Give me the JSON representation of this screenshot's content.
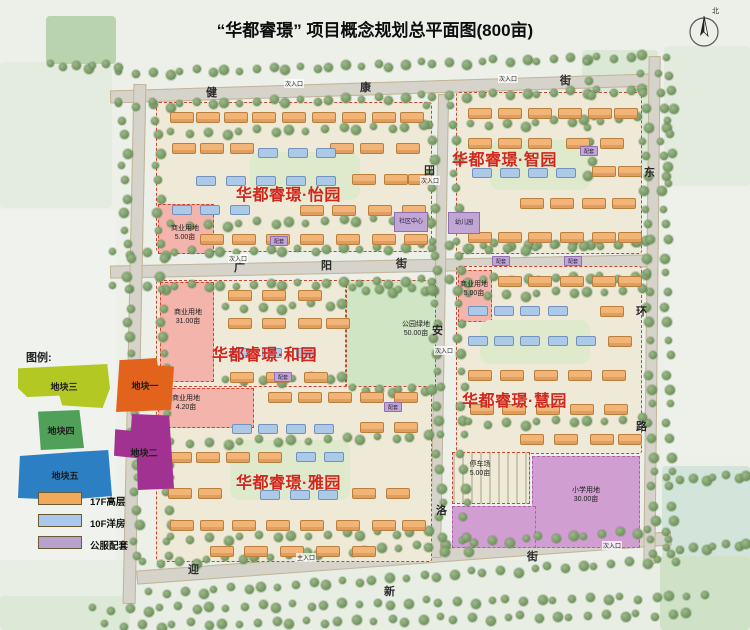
{
  "title": "“华都睿璟” 项目概念规划总平面图(800亩)",
  "compass": {
    "label": "北"
  },
  "legend": {
    "heading": "图例:",
    "plots": [
      {
        "label": "地块一",
        "color": "#e2641c"
      },
      {
        "label": "地块二",
        "color": "#a23292"
      },
      {
        "label": "地块三",
        "color": "#b3c822"
      },
      {
        "label": "地块四",
        "color": "#51a05a"
      },
      {
        "label": "地块五",
        "color": "#2d7fc3"
      }
    ],
    "types": [
      {
        "label": "17F高层",
        "color": "#f1a95e"
      },
      {
        "label": "10F洋房",
        "color": "#a9c8ec"
      },
      {
        "label": "公服配套",
        "color": "#b7a2cf"
      }
    ]
  },
  "gardens": [
    {
      "name": "华都睿璟·怡园"
    },
    {
      "name": "华都睿璟·智园"
    },
    {
      "name": "华都睿璟·和园"
    },
    {
      "name": "华都睿璟·慧园"
    },
    {
      "name": "华都睿璟·雅园"
    }
  ],
  "streets": {
    "jiankang": [
      "健",
      "康",
      "街"
    ],
    "guangyang": [
      "广",
      "阳",
      "街"
    ],
    "yingxin": [
      "迎",
      "新",
      "街"
    ],
    "donghuan": [
      "东",
      "环",
      "路"
    ],
    "inner": [
      "田",
      "安",
      "洛"
    ]
  },
  "landuse": [
    {
      "name": "商业用地",
      "area": "5.00亩"
    },
    {
      "name": "商业用地",
      "area": "31.00亩"
    },
    {
      "name": "商业用地",
      "area": "4.20亩"
    },
    {
      "name": "公园绿地",
      "area": "50.00亩"
    },
    {
      "name": "商业用地",
      "area": "5.00亩"
    },
    {
      "name": "停车场",
      "area": "5.00亩"
    },
    {
      "name": "小学用地",
      "area": "30.00亩"
    }
  ],
  "facilities": {
    "community_center": "社区中心",
    "kindergarten": "幼儿园",
    "amenity": "配套"
  },
  "entrances": {
    "secondary": "次入口",
    "main": "主入口"
  },
  "accent_color": "#d2261b"
}
